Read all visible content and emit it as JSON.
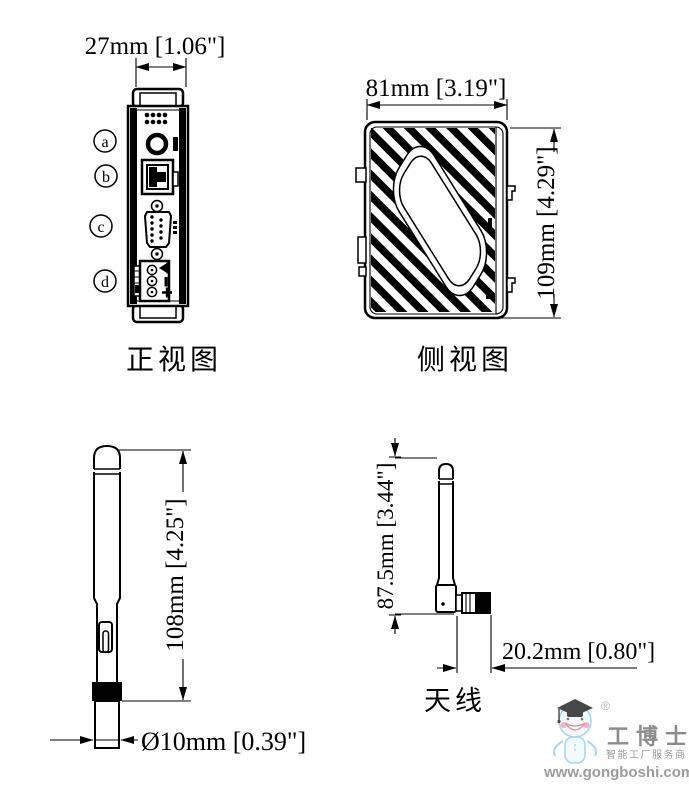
{
  "front_view": {
    "caption": "正视图",
    "width_dimension": "27mm [1.06\"]",
    "port_labels": [
      "a",
      "b",
      "c",
      "d"
    ],
    "terminal_markings": [
      "left-arrow-icon",
      "minus-icon",
      "plus-icon"
    ]
  },
  "side_view": {
    "caption": "侧视图",
    "width_dimension": "81mm [3.19\"]",
    "height_dimension": "109mm [4.29\"]"
  },
  "antenna_straight": {
    "height_dimension": "108mm [4.25\"]",
    "diameter_dimension": "Ø10mm [0.39\"]"
  },
  "antenna_bent": {
    "caption": "天线",
    "height_dimension": "87.5mm [3.44\"]",
    "length_dimension": "20.2mm [0.80\"]"
  },
  "watermark": {
    "registered": "®",
    "brand": "工博士",
    "tagline": "智能工厂服务商",
    "website": "www.gongboshi.com",
    "colors": {
      "text_gray": "#8c8c8c",
      "mascot_blue": "#a6d7ea",
      "mascot_pink": "#f3b3c1",
      "cap_black": "#474747"
    }
  }
}
